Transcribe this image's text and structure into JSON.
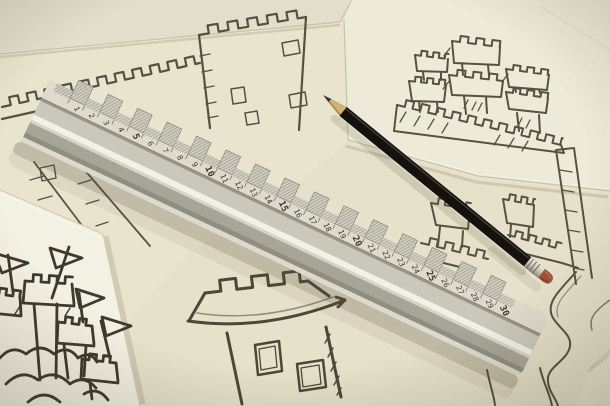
{
  "scene": {
    "description": "Photograph of hand-drawn pencil castle sketches on overlapping sheets of paper, with an aluminium ruler and a black pencil lying across them",
    "background_color": "#8f8870",
    "sketch_stroke_color": "#4b4536",
    "bold_sketch_stroke_color": "#3f3a2c"
  },
  "papers": {
    "corner_top_left": {
      "color": "#e3decc"
    },
    "main": {
      "color": "#e9e4ce"
    },
    "top_right": {
      "color": "#eeead9"
    },
    "bottom_left": {
      "color": "#f3f0e4"
    },
    "bottom": {
      "color": "#e6e1ca"
    },
    "corner_bottom_right": {
      "color": "#eae6d2"
    }
  },
  "ruler": {
    "numbers": [
      1,
      2,
      3,
      4,
      5,
      6,
      7,
      8,
      9,
      10,
      11,
      12,
      13,
      14,
      15,
      16,
      17,
      18,
      19,
      20,
      21,
      22,
      23,
      24,
      25,
      26,
      27,
      28,
      29,
      30
    ],
    "bold_every": 5,
    "scale_face_color": "#dedbcd",
    "body_color": "#c2c0b2",
    "highlight_color": "#f2f0e7",
    "dark_band_color": "#908e81",
    "groove_color": "#98968a",
    "bottom_edge_color": "#dcdacc",
    "digit_color": "#3a382e",
    "hatch_color": "#8f8d7f"
  },
  "pencil": {
    "body_color": "#15110e",
    "body_highlight_color": "#57514a",
    "wood_color": "#d2b176",
    "graphite_color": "#3c372e",
    "ferrule_color": "#c9c6ba",
    "ferrule_ridge_color": "#6f6c61",
    "eraser_color": "#a0513a"
  },
  "sketches": [
    {
      "name": "battlement-wall-top-left",
      "subject": "crenellated castle wall with hatched lower walls"
    },
    {
      "name": "square-tower-top-center",
      "subject": "large square tower with battlements and shaded windows"
    },
    {
      "name": "three-tower-castle-top-right",
      "subject": "castle with three crenellated towers on a battlement wall"
    },
    {
      "name": "fairytale-castle-bottom-left",
      "subject": "castle towers with pennant flags above clouds"
    },
    {
      "name": "round-tower-bottom-center",
      "subject": "round tower with flared battlement cap and two windows"
    },
    {
      "name": "rook-towers-middle-right",
      "subject": "small rook towers and a tall tower"
    },
    {
      "name": "winding-lines-bottom-right",
      "subject": "wavy sketched lines"
    }
  ]
}
